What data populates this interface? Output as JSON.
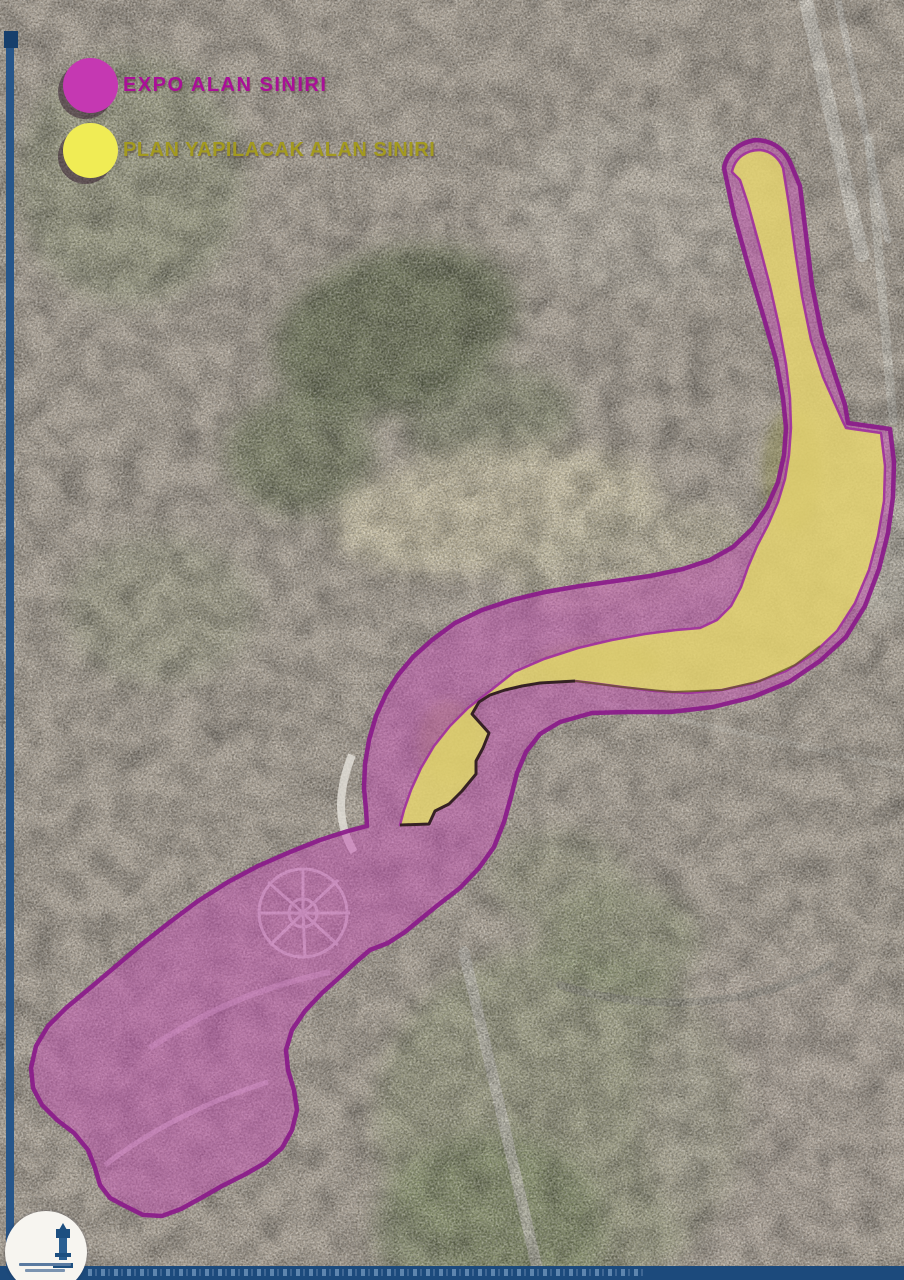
{
  "map": {
    "type": "satellite-planning-map",
    "legend": {
      "items": [
        {
          "id": "expo",
          "label": "EXPO ALAN SINIRI",
          "swatch_color": "#c538b2",
          "label_color": "#aa0f98"
        },
        {
          "id": "plan",
          "label": "PLAN YAPILACAK ALAN SINIRI",
          "swatch_color": "#f0ec55",
          "label_color": "#a39a1f"
        }
      ]
    },
    "overlays": {
      "expo": {
        "fill": "#c350b4",
        "stroke": "#8a1a8a"
      },
      "plan": {
        "fill": "#eaec62",
        "stroke": "#a02d9e",
        "edge_stroke": "#231d10"
      }
    },
    "footer": {
      "bar_color": "#1c4a7c",
      "logo_icon": "izmir-clock-tower-logo"
    }
  }
}
